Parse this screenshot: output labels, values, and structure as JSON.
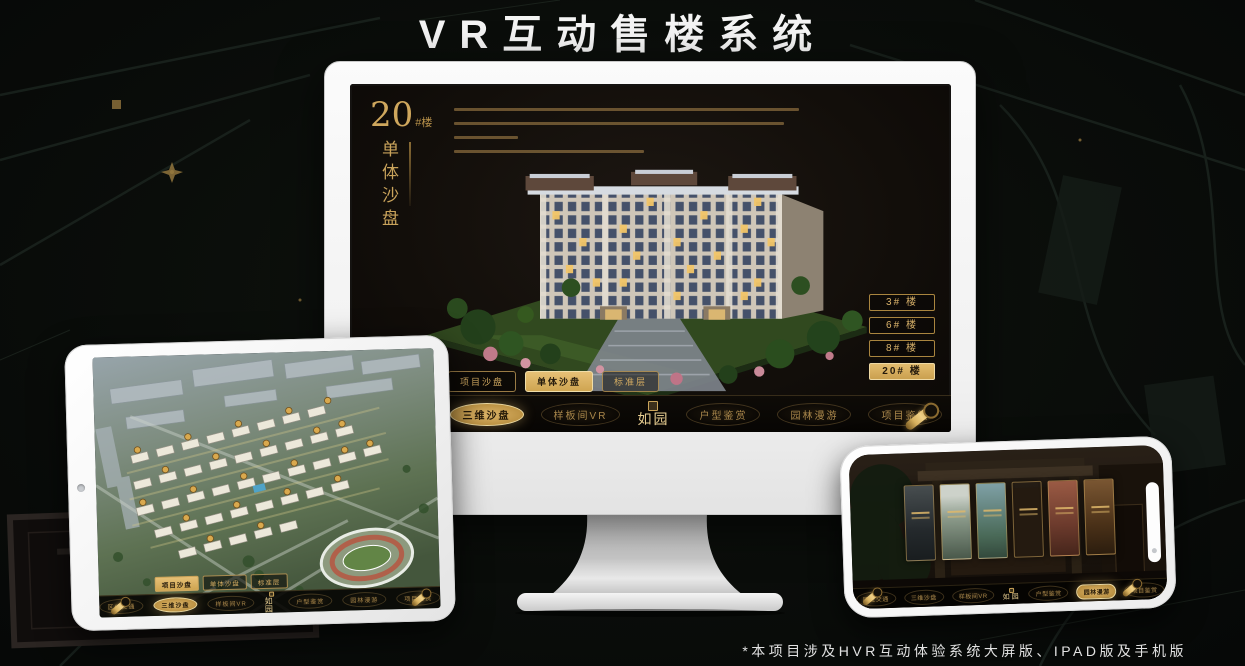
{
  "title": "VR互动售楼系统",
  "footnote": "*本项目涉及HVR互动体验系统大屏版、IPAD版及手机版",
  "colors": {
    "gold": "#cda454",
    "gold_bright": "#e8c87e",
    "screen_bg": "#17120d",
    "frame": "#f5f5f5"
  },
  "app": {
    "logo": "如园",
    "tabs": [
      {
        "label": "项目沙盘"
      },
      {
        "label": "单体沙盘"
      },
      {
        "label": "标准层"
      }
    ],
    "nav_items": [
      {
        "label": "区位交通"
      },
      {
        "label": "三维沙盘"
      },
      {
        "label": "样板间VR"
      },
      {
        "label": "户型鉴赏"
      },
      {
        "label": "园林漫游"
      },
      {
        "label": "项目鉴赏"
      }
    ]
  },
  "monitor_screen": {
    "building_label_number": "20",
    "building_label_suffix": "#楼",
    "building_label_vertical": "单体沙盘",
    "floor_buttons": [
      {
        "label": "3# 楼"
      },
      {
        "label": "6# 楼"
      },
      {
        "label": "8# 楼"
      },
      {
        "label": "20# 楼"
      }
    ]
  }
}
